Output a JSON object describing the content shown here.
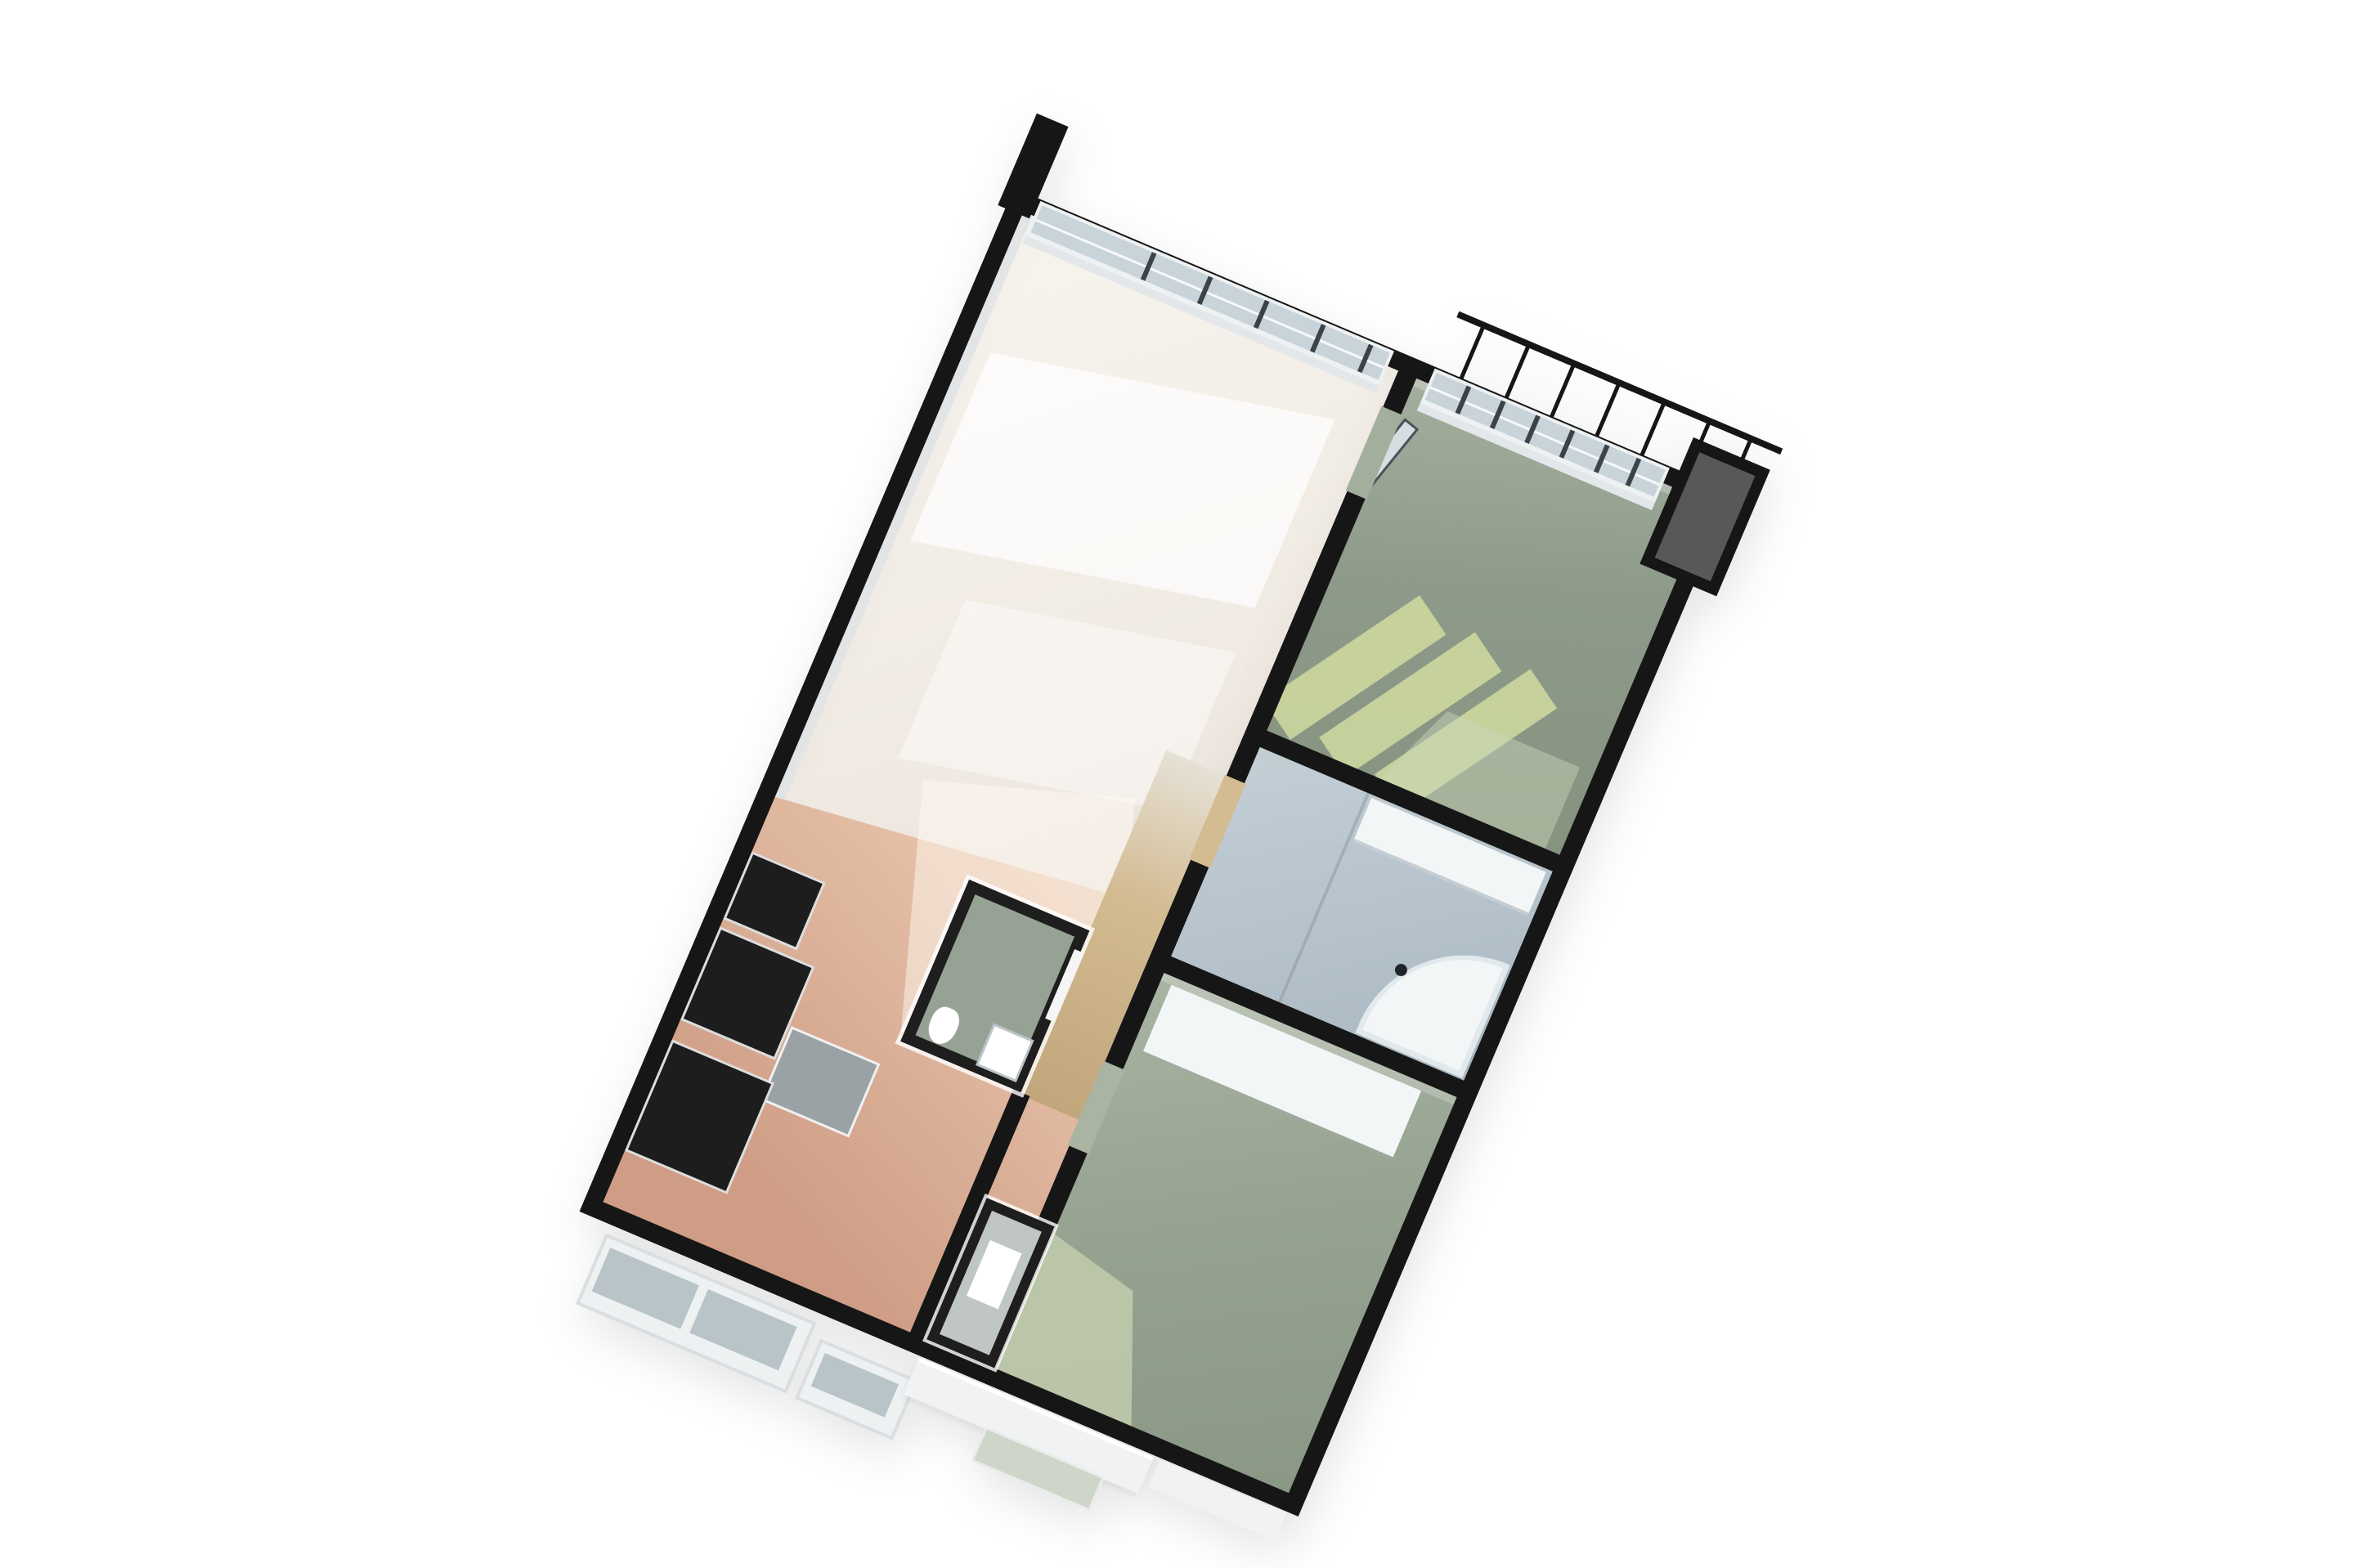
{
  "scene": {
    "description": "3D axonometric floor plan rendering of a two-bedroom apartment on a white background, rotated clockwise, with black walls"
  },
  "rooms": [
    "living-room",
    "kitchen",
    "dining-area",
    "hallway",
    "wc",
    "closet",
    "bedroom-1",
    "bathroom",
    "bedroom-2",
    "balcony-railing",
    "utility-shaft"
  ],
  "counts": {
    "living_window_mullions": 5,
    "bedroom1_window_mullions": 6,
    "railing_posts": 7,
    "sunlight_stripes": 3
  },
  "colors": {
    "background": "#ffffff",
    "wall": "#161616",
    "wall_dark": "#1e1e1e",
    "glass": "#c9d3da",
    "mullion": "#3c4249",
    "frame": "#eef1f2",
    "inner_face": "#e3e7ea",
    "living_floor": "#efe9e1",
    "living_light": "#f7f4ee",
    "living_dark": "#ddd7d0",
    "dining_light": "#e9c6ae",
    "dining_deep": "#cf9d85",
    "hall_top": "#e6e1d6",
    "hall_light": "#d3bb92",
    "hall_deep": "#c2a67c",
    "wc_floor": "#96a294",
    "closet_floor": "#c0c6c1",
    "bedroom1_floor": "#8d9a8a",
    "bedroom1_light": "#a3af9d",
    "bedroom1_dark": "#86937f",
    "stripe": "#ccd79e",
    "bedroom2_floor": "#95a290",
    "bedroom2_light": "#a9b4a2",
    "bedroom2_dark": "#8b9886",
    "sun_patch": "#c2cbad",
    "bathroom_floor": "#b5c2cb",
    "bathroom_light": "#c3ced5",
    "bathroom_dark": "#a8b6bf",
    "fixture": "#f3f6f7",
    "kitchen_unit": "#1d1d1d",
    "counter": "#9aa2a6",
    "shaft": "#585858",
    "tub_dot": "#20242a",
    "sill": "#eef1f2",
    "sill_glass": "#b9c4c9",
    "pane_green": "#cdd6c9",
    "ledge": "#f0f2f3"
  }
}
